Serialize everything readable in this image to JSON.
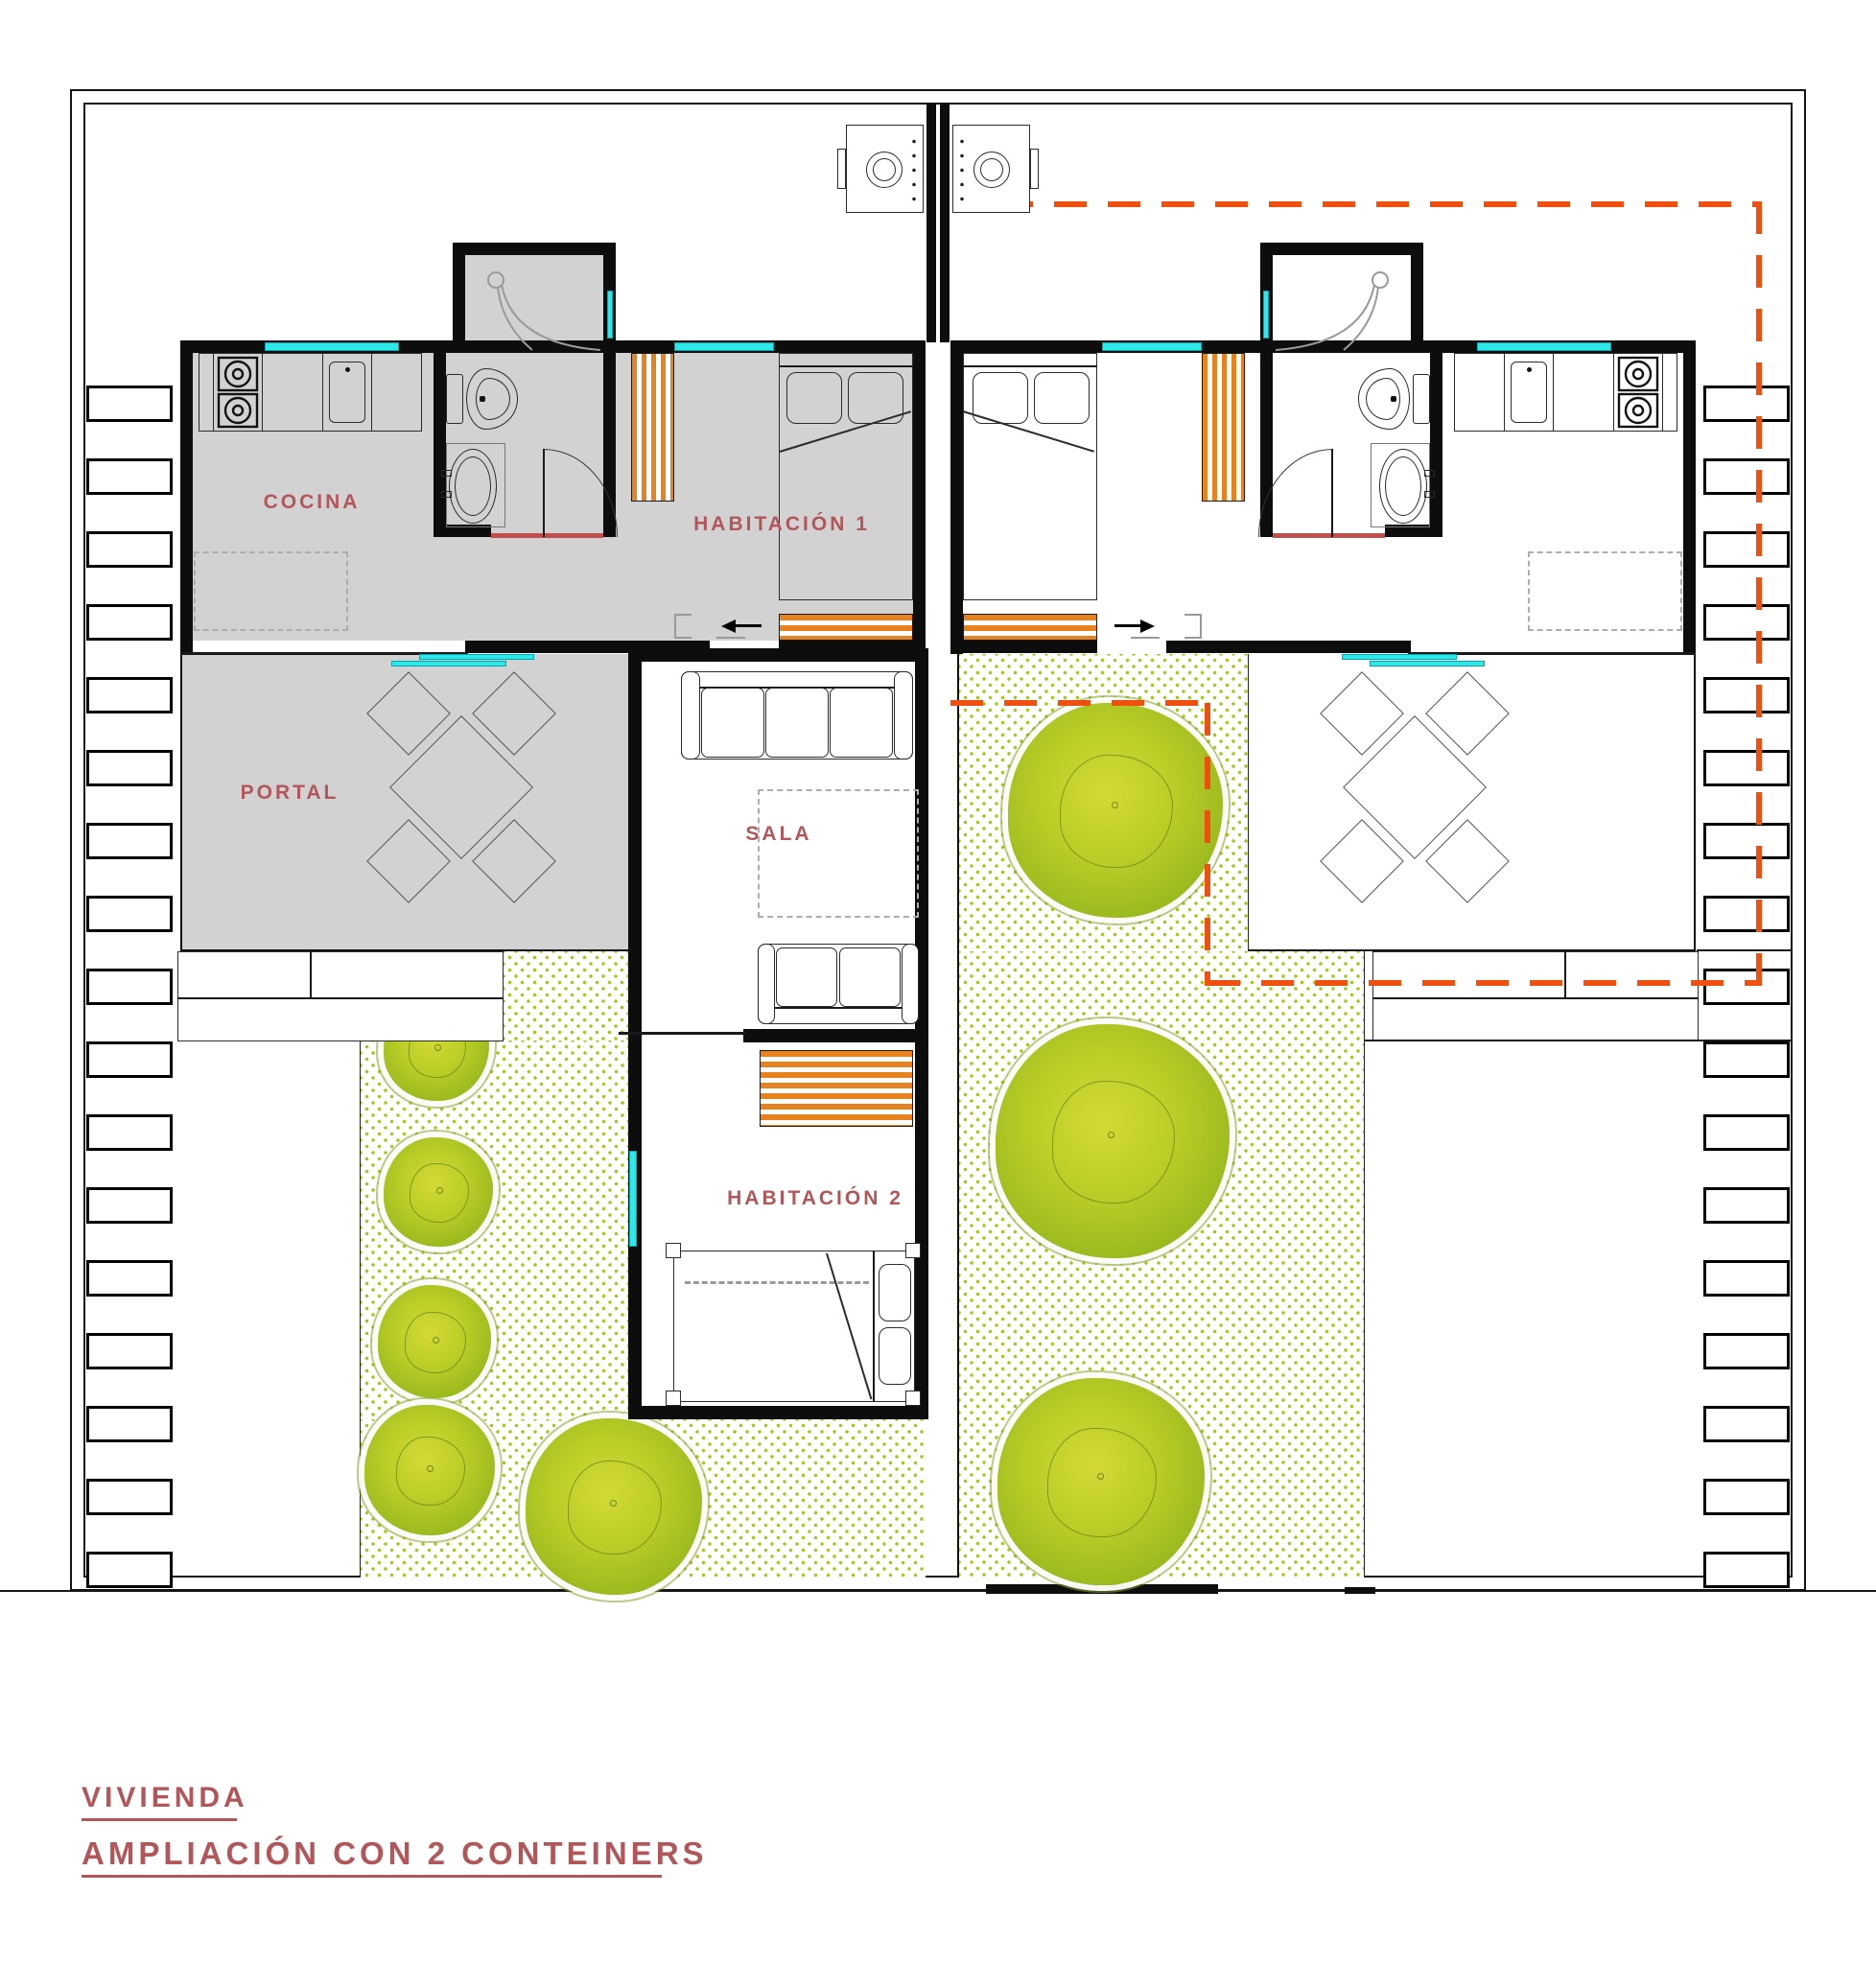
{
  "drawing": {
    "title_line1": "VIVIENDA",
    "title_line2": "AMPLIACIÓN CON 2 CONTEINERS"
  },
  "rooms": {
    "cocina": "COCINA",
    "portal": "PORTAL",
    "habitacion1": "HABITACIÓN 1",
    "sala": "SALA",
    "habitacion2": "HABITACIÓN 2"
  },
  "colors": {
    "label_red": "#b2565a",
    "existing_room_fill": "#d2d2d2",
    "window_cyan": "#2ee8e8",
    "deck_stripe_orange": "#e8821e",
    "extension_dash_orange": "#f0500f",
    "garden_dot_green": "#a6c916",
    "door_threshold_red": "#c0504d",
    "tree_green": "#9cbb1e"
  },
  "site": {
    "edge_box_rows": 17
  }
}
